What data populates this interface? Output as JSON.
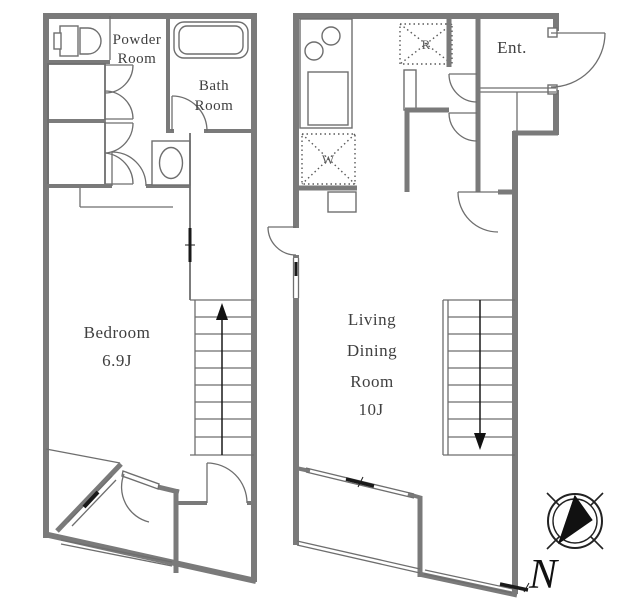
{
  "left_plan": {
    "powder_room": {
      "line1": "Powder",
      "line2": "Room"
    },
    "bath_room": {
      "line1": "Bath",
      "line2": "Room"
    },
    "bedroom": {
      "name": "Bedroom",
      "size": "6.9J"
    }
  },
  "right_plan": {
    "living_dining_room": {
      "line1": "Living",
      "line2": "Dining",
      "line3": "Room",
      "size": "10J"
    },
    "entrance": {
      "label": "Ent."
    },
    "refrigerator_label": "R",
    "washer_label": "W"
  },
  "compass": {
    "north": "N"
  },
  "colors": {
    "wall": "#7a7a7a",
    "thin_line": "#6e6e6e",
    "text": "#3f3f3f",
    "accent_black": "#1a1a1a"
  }
}
